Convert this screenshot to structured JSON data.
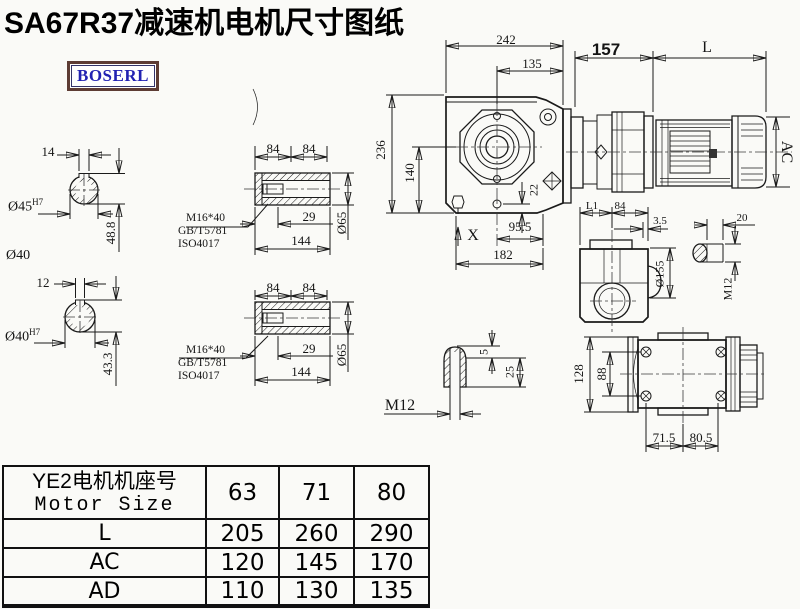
{
  "title": "SA67R37减速机电机尺寸图纸",
  "logo": "BOSERL",
  "bolt_note": {
    "line1": "M16*40",
    "line2": "GB/T5781",
    "line3": "ISO4017"
  },
  "dims": {
    "shaft1_key_w": "14",
    "shaft1_bore": "Ø45",
    "shaft1_bore_tol": "H7",
    "shaft1_height": "48.8",
    "shaft1_alt": "Ø40",
    "shaft2_key_w": "12",
    "shaft2_bore": "Ø40",
    "shaft2_bore_tol": "H7",
    "shaft2_height": "43.3",
    "hub1_len_a": "84",
    "hub1_len_b": "84",
    "hub1_depth": "29",
    "hub1_total": "144",
    "hub1_od": "Ø65",
    "hub2_len_a": "84",
    "hub2_len_b": "84",
    "hub2_depth": "29",
    "hub2_total": "144",
    "hub2_od": "Ø65",
    "main_width": "242",
    "main_face": "135",
    "main_input": "157",
    "motor_len": "L",
    "motor_ac": "AC",
    "main_height": "236",
    "axis_height": "140",
    "foot_offset": "22",
    "x_mark": "X",
    "center_face": "95.5",
    "base_len": "182",
    "side_l1": "L1",
    "side_len": "84",
    "side_gap": "3.5",
    "side_flange": "Ø155",
    "bush_len": "20",
    "bush_thread": "M12",
    "key_h": "5",
    "key_d": "25",
    "key_thread": "M12",
    "rear_h": "128",
    "rear_bolt": "88",
    "rear_a": "71.5",
    "rear_b": "80.5"
  },
  "table": {
    "header": {
      "title_cn": "YE2电机机座号",
      "title_en": "Motor Size",
      "cols": [
        "63",
        "71",
        "80"
      ]
    },
    "rows": [
      {
        "label": "L",
        "values": [
          "205",
          "260",
          "290"
        ]
      },
      {
        "label": "AC",
        "values": [
          "120",
          "145",
          "170"
        ]
      },
      {
        "label": "AD",
        "values": [
          "110",
          "130",
          "135"
        ]
      }
    ]
  },
  "colors": {
    "line": "#1a1a1a",
    "logo_text": "#2222b2",
    "logo_border": "#5d3c34",
    "paper": "#fafaf7"
  }
}
